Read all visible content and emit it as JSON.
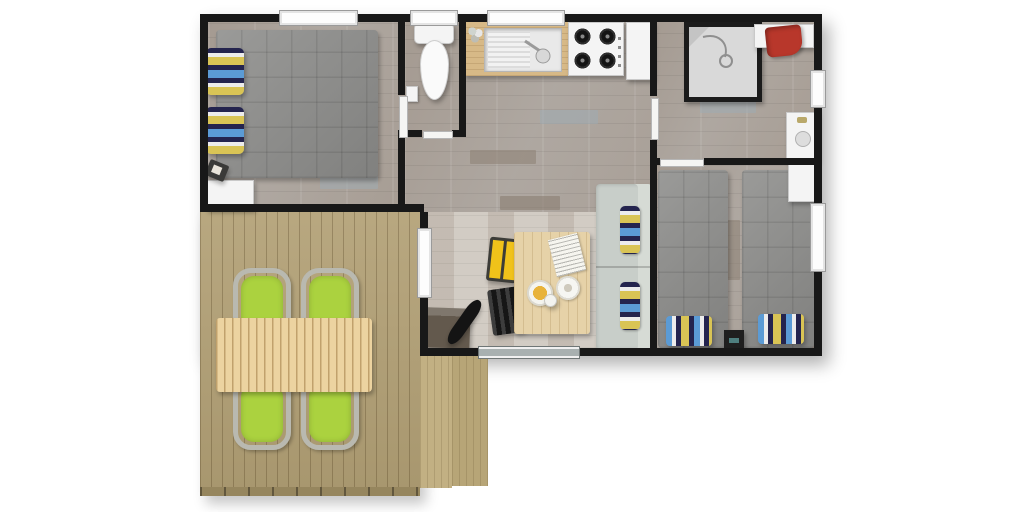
{
  "title": "Mobile home 3D floor plan with terrace",
  "colors": {
    "wall": "#181818",
    "floor": "#b0a79e",
    "floor_dining": "#ccc5bc",
    "deck": "#b2a075",
    "deck_step": "#c2b083",
    "deck_fascia": "#96865e",
    "table_deck": "#ecd3a0",
    "table_dining": "#e6d2a8",
    "counter": "#d7b987",
    "bed": "#8f8f8d",
    "sofa": "#c8cec9",
    "chair_green": "#abd23f",
    "chair_yellow": "#f0c21a",
    "towel_red": "#b8372b",
    "pillow_navy": "#24244e",
    "pillow_blue": "#5b9bd5",
    "pillow_yellow": "#d9c455",
    "fixture": "#f4f4f4",
    "cabinet_dark": "#63594d",
    "glass": "#a8b0b0"
  },
  "rooms": {
    "master_bedroom": {
      "name": "Master bedroom",
      "furniture": [
        "double bed",
        "striped pillows (2)",
        "white dresser",
        "bag"
      ]
    },
    "wc": {
      "name": "WC",
      "furniture": [
        "toilet",
        "paper holder"
      ]
    },
    "kitchen": {
      "name": "Kitchen",
      "furniture": [
        "sink counter",
        "gas hob (4 burners)",
        "fridge cabinet",
        "flower pot"
      ]
    },
    "shower_room": {
      "name": "Shower room",
      "furniture": [
        "shower cabin",
        "towel shelf",
        "red towel",
        "washbasin"
      ]
    },
    "twin_bedroom": {
      "name": "Twin bedroom",
      "furniture": [
        "twin bed left",
        "twin bed right",
        "striped pillows (2)",
        "black nightstand",
        "white cabinet"
      ]
    },
    "living_dining": {
      "name": "Living / dining room",
      "furniture": [
        "dining table",
        "newspaper",
        "food plate",
        "white plate",
        "cup",
        "yellow chair",
        "black slat chair",
        "bench sofa with cushions",
        "dark storage chest",
        "guitar",
        "sliding glass door"
      ]
    },
    "terrace": {
      "name": "Terrace deck",
      "furniture": [
        "slatted picnic table",
        "green wicker chairs (4)",
        "wooden steps (2)"
      ]
    }
  }
}
